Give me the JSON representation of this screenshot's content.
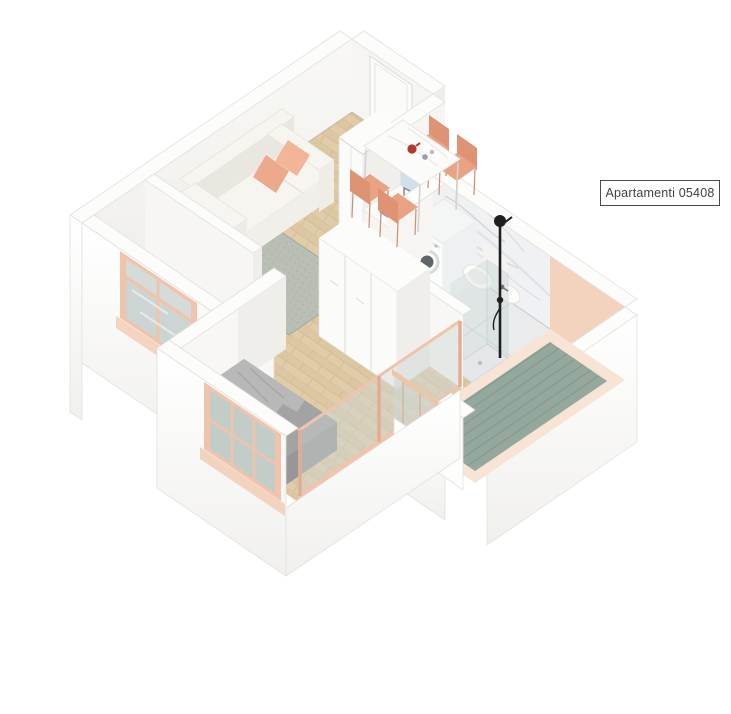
{
  "label": {
    "text": "Apartamenti 05408"
  },
  "scene": {
    "type": "isometric-apartment-floor-plan",
    "rooms": [
      "living-dining-room",
      "kitchen",
      "bathroom",
      "bedroom",
      "hallway",
      "balcony-right",
      "entry"
    ],
    "furniture": [
      "sofa",
      "rug",
      "dining-table",
      "dining-chairs",
      "tall-kitchen-cabinet",
      "kitchen-counter-with-sink",
      "washing-machine",
      "wall-hung-toilet",
      "bidet",
      "shower-column",
      "shower-glass",
      "wardrobe",
      "double-bed",
      "balcony-railing",
      "entry-door",
      "living-room-window",
      "bedroom-window",
      "bedroom-glazing"
    ],
    "counts": {
      "dining_chairs": 4,
      "sofa_pillows": 2
    }
  },
  "colors": {
    "wood": "#dcc7a3",
    "wood_line": "#c9b28b",
    "rug": "#b9bfb4",
    "mat_green": "#94a89e",
    "peach": "#f0c3ac",
    "peach_dark": "#e3ac92",
    "pink_wall": "#f3d3bd",
    "pink_wall_light": "#f8dfcb",
    "balcony_floor": "#f7e4d5",
    "bath_floor": "#e9ebed",
    "marble_vein": "#c6c9ce",
    "glass": "#ccd8d5",
    "backsplash": "#cfe0e6",
    "sofa": "#f7f5f0",
    "sofa_shade": "#eae7e0",
    "pillow": "#f2b597",
    "pillow2": "#eda98b",
    "chair": "#eaa284",
    "chair_dark": "#dd9374",
    "bed_gray": "#a3a3a3",
    "bed_dark": "#8d8d8d",
    "blanket": "#b8b8b8",
    "black": "#1f1f1f",
    "steel": "#9aa0a2",
    "wall_top": "#fcfcfa",
    "wall_light": "#f6f5f2",
    "wall_mid": "#efeeea",
    "edge": "#e2e1dd",
    "teapot": "#b03a2e",
    "label_border": "#4a4a4a",
    "label_text": "#3f3f3f"
  }
}
